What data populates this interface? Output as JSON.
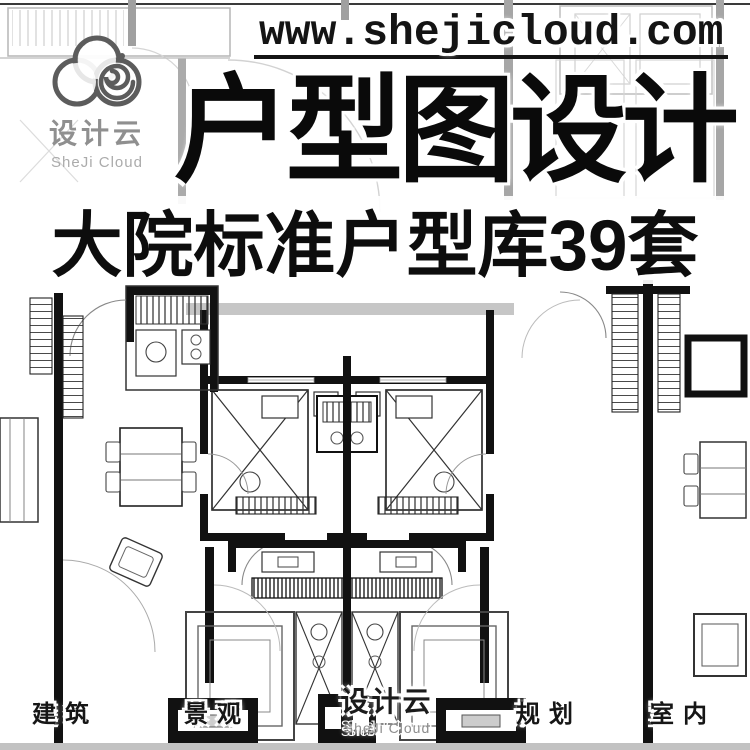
{
  "poster": {
    "website_url": "www.shejicloud.com",
    "title": "户型图设计",
    "subtitle": "大院标准户型库39套"
  },
  "logo": {
    "name_zh": "设计云",
    "name_en": "SheJi Cloud",
    "icon": "cloud-spiral-icon"
  },
  "footer": {
    "categories": [
      "建筑",
      "景观",
      "规划",
      "室内"
    ],
    "logo_zh": "设计云",
    "logo_en": "SheJi Cloud"
  },
  "background": {
    "description": "symmetric-apartment-floor-plan-drawing"
  },
  "colors": {
    "ink": "#141414",
    "title_ink": "#0a0a0a",
    "logo_gray": "#8f8f8f",
    "logo_gray_light": "#ababab",
    "bottom_bar": "#c2c2c2",
    "plan_black": "#111111",
    "plan_light": "#bdbdbd"
  }
}
